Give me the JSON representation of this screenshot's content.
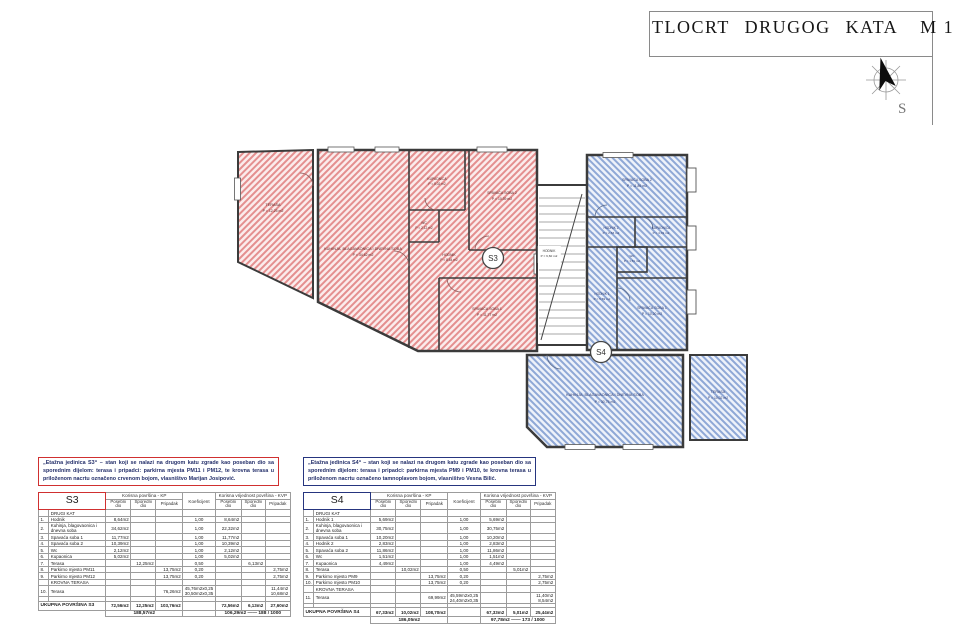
{
  "title_block": {
    "title": "TLOCRT  DRUGOG  KATA",
    "scale": "M 1 : 100"
  },
  "compass": {
    "label": "S"
  },
  "plan": {
    "s3": {
      "badge": "S3",
      "rooms": {
        "terasa": {
          "name": "TERASA",
          "area": "P = 12,25 m2"
        },
        "kuhinja": {
          "name": "KUHINJA, BLAGAVAONICA I DNEVNA SOBA",
          "area": "P = 34,62 m2"
        },
        "kupaonica": {
          "name": "KUPAONICA",
          "area": "P = 5,02 m2"
        },
        "wc": {
          "name": "WC",
          "area": "P = 2,12 m2"
        },
        "spavaca2": {
          "name": "SPAVAĆA SOBA 2",
          "area": "P = 10,39 m2"
        },
        "spavaca1": {
          "name": "SPAVAĆA SOBA 1",
          "area": "P = 11,77 m2"
        },
        "hodnik": {
          "name": "HODNIK",
          "area": "P = 8,64 m2"
        }
      }
    },
    "s4": {
      "badge": "S4",
      "rooms": {
        "spavaca2": {
          "name": "SPAVAĆA SOBA 2",
          "area": "P = 11,86 m2"
        },
        "hodnik2": {
          "name": "HODNIK 2",
          "area": "P = 2,83 m2"
        },
        "kupaonica": {
          "name": "KUPAONICA",
          "area": "P = 4,49 m2"
        },
        "wc": {
          "name": "WC",
          "area": "P = 1,51 m2"
        },
        "hodnik1": {
          "name": "HODNIK 1",
          "area": "P = 5,69 m2"
        },
        "spavaca1": {
          "name": "SPAVAĆA SOBA 1",
          "area": "P = 10,20 m2"
        },
        "kuhinja": {
          "name": "KUHINJA, BLAGAVAONICA I DNEVNA SOBA",
          "area": "P = 30,75 m2"
        },
        "terasa": {
          "name": "TERASA",
          "area": "P = 10,02 m2"
        }
      }
    },
    "stubiste": {
      "name": "HODNIK",
      "area": "P = 9,60 m2"
    }
  },
  "descriptions": {
    "s3": "„Etažna jedinica S3“ – stan koji se nalazi na drugom katu zgrade kao poseban dio sa sporednim dijelom: terasa i pripadci: parkirna mjesta PM11 i PM12, te krovna terasa u priloženom nacrtu označeno crvenom bojom, vlasništvo Marijan Josipović.",
    "s4": "„Etažna jedinica S4“ – stan koji se nalazi na drugom katu zgrade kao poseban dio sa sporednim dijelom: terasa i pripadci: parkirna mjesta PM9 i PM10, te krovna terasa u priloženom nacrtu označeno tamnoplavom bojom, vlasništvo Vesna Bilić."
  },
  "tables": {
    "s3": {
      "unit": "S3",
      "group_headers": [
        "Korisna površina - KP",
        "Koeficijent",
        "Korisna vrijednost površina - KVP"
      ],
      "sub_headers": [
        "Posebni dio",
        "Sporedni dio",
        "Pripadak",
        "Posebni dio",
        "Sporedni dio",
        "Pripadak"
      ],
      "section1": "DRUGI KAT",
      "rows": [
        {
          "section": "DRUGI KAT"
        },
        {
          "num": "1.",
          "name": "Hodnik",
          "c": [
            "8,64m2",
            "",
            "",
            "1,00",
            "8,64m2",
            "",
            ""
          ]
        },
        {
          "num": "2.",
          "name": "Kuhinja, blagovaonica i dnevna soba",
          "c": [
            "34,62m2",
            "",
            "",
            "1,00",
            "22,32m2",
            "",
            ""
          ]
        },
        {
          "num": "3.",
          "name": "Spavaća soba 1",
          "c": [
            "11,77m2",
            "",
            "",
            "1,00",
            "11,77m2",
            "",
            ""
          ]
        },
        {
          "num": "4.",
          "name": "Spavaća soba 2",
          "c": [
            "10,39m2",
            "",
            "",
            "1,00",
            "10,39m2",
            "",
            ""
          ]
        },
        {
          "num": "5.",
          "name": "Wc",
          "c": [
            "2,12m2",
            "",
            "",
            "1,00",
            "2,12m2",
            "",
            ""
          ]
        },
        {
          "num": "6.",
          "name": "Kupaonica",
          "c": [
            "5,02m2",
            "",
            "",
            "1,00",
            "5,02m2",
            "",
            ""
          ]
        },
        {
          "num": "7.",
          "name": "Terasa",
          "c": [
            "",
            "12,25m2",
            "",
            "0,50",
            "",
            "6,13m2",
            ""
          ]
        },
        {
          "num": "8.",
          "name": "Parkirno mjesto PM11",
          "c": [
            "",
            "",
            "13,75m2",
            "0,20",
            "",
            "",
            "2,75m2"
          ]
        },
        {
          "num": "9.",
          "name": "Parkirno mjesto PM12",
          "c": [
            "",
            "",
            "13,75m2",
            "0,20",
            "",
            "",
            "2,75m2"
          ]
        },
        {
          "section": "KROVNA TERASA"
        },
        {
          "num": "10.",
          "name": "Terasa",
          "c": [
            "",
            "",
            "76,26m2",
            "45,76m2x0,25\n30,50m2x0,35",
            "",
            "",
            "11,44m2\n10,68m2"
          ]
        }
      ],
      "total_label": "UKUPNA POVRŠINA S3",
      "total_cells": [
        "72,56m2",
        "12,25m2",
        "103,76m2",
        "",
        "72,56m2",
        "6,13m2",
        "27,60m2"
      ],
      "grand_kp": "188,57m2",
      "grand_kvp": "106,29m2 —— 188 / 1000"
    },
    "s4": {
      "unit": "S4",
      "group_headers": [
        "Korisna površina - KP",
        "Koeficijent",
        "Korisna vrijednost površina - KVP"
      ],
      "sub_headers": [
        "Posebni dio",
        "Sporedni dio",
        "Pripadak",
        "Posebni dio",
        "Sporedni dio",
        "Pripadak"
      ],
      "rows": [
        {
          "section": "DRUGI KAT"
        },
        {
          "num": "1.",
          "name": "Hodnik 1",
          "c": [
            "5,69m2",
            "",
            "",
            "1,00",
            "5,69m2",
            "",
            ""
          ]
        },
        {
          "num": "2.",
          "name": "Kuhinja, blagovaonica i dnevna soba",
          "c": [
            "30,75m2",
            "",
            "",
            "1,00",
            "30,75m2",
            "",
            ""
          ]
        },
        {
          "num": "3.",
          "name": "Spavaća soba 1",
          "c": [
            "10,20m2",
            "",
            "",
            "1,00",
            "10,20m2",
            "",
            ""
          ]
        },
        {
          "num": "4.",
          "name": "Hodnik 2",
          "c": [
            "2,83m2",
            "",
            "",
            "1,00",
            "2,83m2",
            "",
            ""
          ]
        },
        {
          "num": "5.",
          "name": "Spavaća soba 2",
          "c": [
            "11,86m2",
            "",
            "",
            "1,00",
            "11,86m2",
            "",
            ""
          ]
        },
        {
          "num": "6.",
          "name": "Wc",
          "c": [
            "1,51m2",
            "",
            "",
            "1,00",
            "1,51m2",
            "",
            ""
          ]
        },
        {
          "num": "7.",
          "name": "Kupaonica",
          "c": [
            "4,49m2",
            "",
            "",
            "1,00",
            "4,49m2",
            "",
            ""
          ]
        },
        {
          "num": "8.",
          "name": "Terasa",
          "c": [
            "",
            "10,02m2",
            "",
            "0,50",
            "",
            "5,01m2",
            ""
          ]
        },
        {
          "num": "9.",
          "name": "Parkirno mjesto PM9",
          "c": [
            "",
            "",
            "13,75m2",
            "0,20",
            "",
            "",
            "2,75m2"
          ]
        },
        {
          "num": "10.",
          "name": "Parkirno mjesto PM10",
          "c": [
            "",
            "",
            "13,75m2",
            "0,20",
            "",
            "",
            "2,75m2"
          ]
        },
        {
          "section": "KROVNA TERASA"
        },
        {
          "num": "11.",
          "name": "Terasa",
          "c": [
            "",
            "",
            "69,99m2",
            "45,59m2x0,25\n24,40m2x0,35",
            "",
            "",
            "11,40m2\n8,54m2"
          ]
        }
      ],
      "total_label": "UKUPNA POVRŠINA S4",
      "total_cells": [
        "67,33m2",
        "10,02m2",
        "108,70m2",
        "",
        "67,33m2",
        "5,01m2",
        "25,44m2"
      ],
      "grand_kp": "186,05m2",
      "grand_kvp": "97,78m2 —— 173 / 1000"
    }
  }
}
